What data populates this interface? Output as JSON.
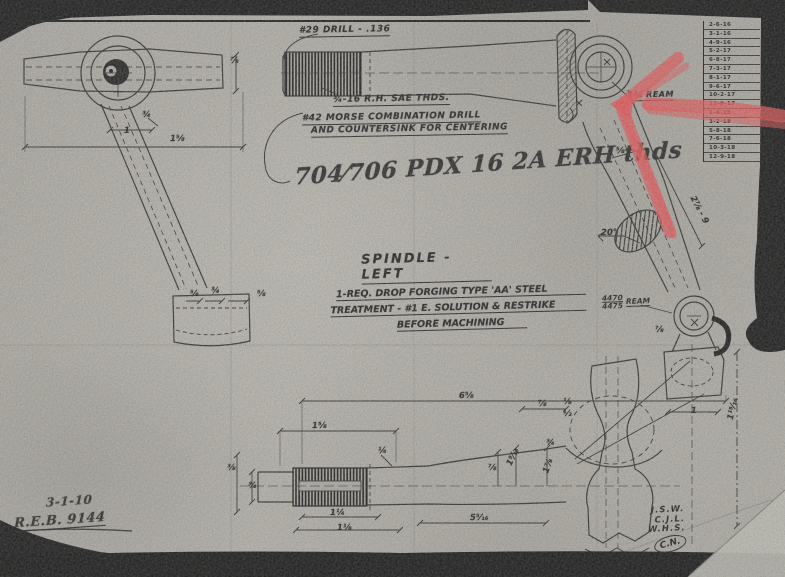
{
  "labels": {
    "drill_note": "#29 DRILL - .136",
    "sae_thread_note": "¾-16 R.H. SAE THDS.",
    "centering_note_line1": "#42 MORSE COMBINATION DRILL",
    "centering_note_line2": "AND COUNTERSINK FOR CENTERING",
    "handwritten_note": "704⁄706 PDX 16 2A ERH thds",
    "ream_callout": "1¼ REAM",
    "bore_ream_numerator": "4470",
    "bore_ream_denominator": "4475",
    "bore_ream_word": "REAM"
  },
  "title_block": {
    "title": "SPINDLE - LEFT",
    "quantity": "1-REQ.",
    "material": "DROP FORGING TYPE 'AA' STEEL",
    "treatment_line1": "TREATMENT - #1 E. SOLUTION & RESTRIKE",
    "treatment_line2": "BEFORE MACHINING"
  },
  "dimensions": [
    {
      "t": "⅞"
    },
    {
      "t": "¾"
    },
    {
      "t": "1"
    },
    {
      "t": "1⅝"
    },
    {
      "t": "⅝"
    },
    {
      "t": "¾"
    },
    {
      "t": "⅝"
    },
    {
      "t": "⅝"
    },
    {
      "t": "20°"
    },
    {
      "t": "2⅞ - 9"
    },
    {
      "t": "1⅝"
    },
    {
      "t": "6⅝"
    },
    {
      "t": "⅞"
    },
    {
      "t": "¼"
    },
    {
      "t": "⅞"
    },
    {
      "t": "1⁹⁄₁₆"
    },
    {
      "t": "⅜"
    },
    {
      "t": "¾"
    },
    {
      "t": "1¼"
    },
    {
      "t": "1⅛"
    },
    {
      "t": "5⁵⁄₁₆"
    },
    {
      "t": "⅛"
    },
    {
      "t": "½"
    },
    {
      "t": "¾"
    },
    {
      "t": "1⅞"
    },
    {
      "t": "1"
    },
    {
      "t": "1¹⁵⁄₁₆"
    },
    {
      "t": "⅞"
    }
  ],
  "revision_table": {
    "rows": [
      "2-6-16",
      "3-1-16",
      "4-9-16",
      "5-2-17",
      "6-8-17",
      "7-3-17",
      "8-1-17",
      "9-6-17",
      "10-2-17",
      "11-9-17",
      "1-4-18",
      "3-2-18",
      "5-8-18",
      "7-6-18",
      "10-3-18",
      "12-9-18"
    ]
  },
  "signatures": {
    "bottom_left_line1": "3-1-10",
    "bottom_left_line2": "R.E.B. 9144",
    "initials": [
      "J.S.W.",
      "C.J.L.",
      "W.H.S."
    ],
    "circled": "C.N."
  },
  "colors": {
    "paper": "#b4b1a9",
    "ink": "#1f1f1f",
    "annotation_red": "#ef5456",
    "scan_black": "#121212"
  }
}
